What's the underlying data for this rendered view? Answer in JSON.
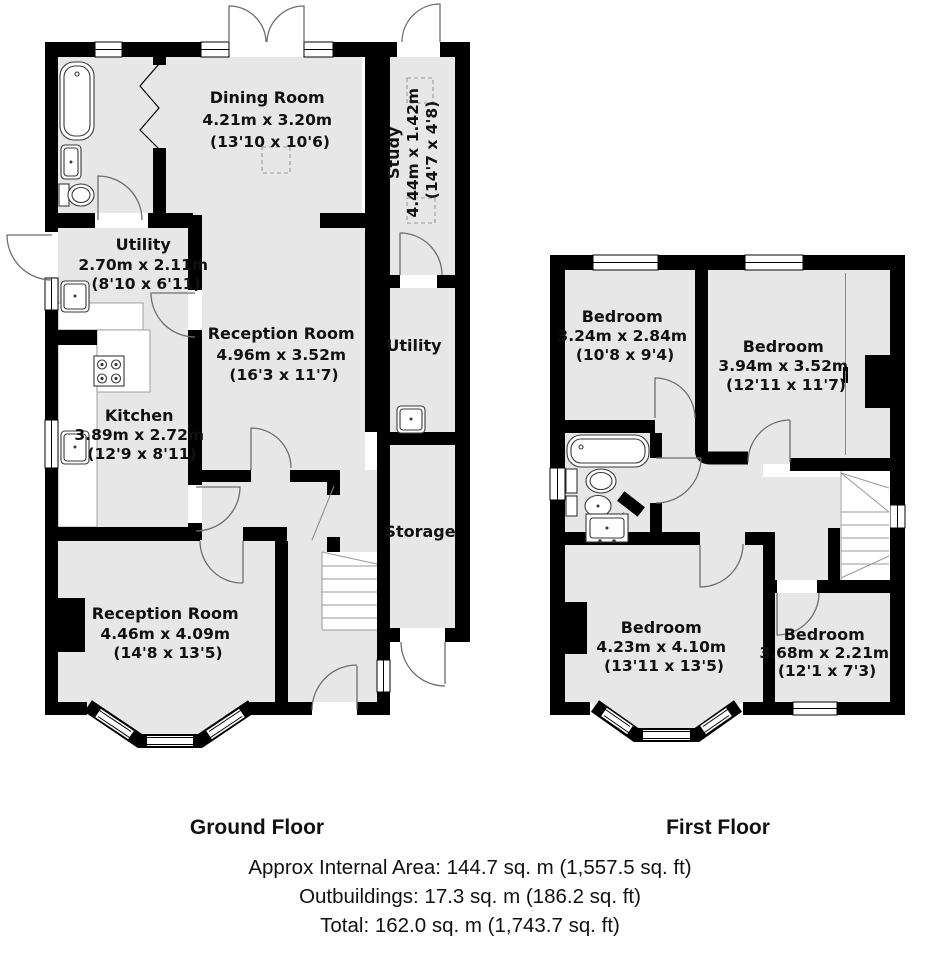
{
  "colors": {
    "wall": "#000000",
    "floor_fill": "#e7e7e7",
    "background": "#ffffff",
    "door_arc": "#6e6e6e"
  },
  "ground_floor": {
    "caption": "Ground Floor",
    "rooms": {
      "dining": {
        "name": "Dining Room",
        "metric": "4.21m x 3.20m",
        "imperial": "(13'10 x 10'6)"
      },
      "study": {
        "name": "Study",
        "metric": "4.44m x 1.42m",
        "imperial": "(14'7 x 4'8)"
      },
      "utility": {
        "name": "Utility",
        "metric": "2.70m x 2.11m",
        "imperial": "(8'10 x 6'11)"
      },
      "reception_top": {
        "name": "Reception Room",
        "metric": "4.96m x 3.52m",
        "imperial": "(16'3 x 11'7)"
      },
      "kitchen": {
        "name": "Kitchen",
        "metric": "3.89m x 2.72m",
        "imperial": "(12'9 x 8'11)"
      },
      "utility2": {
        "name": "Utility"
      },
      "storage": {
        "name": "Storage"
      },
      "reception_bottom": {
        "name": "Reception Room",
        "metric": "4.46m x 4.09m",
        "imperial": "(14'8 x 13'5)"
      }
    }
  },
  "first_floor": {
    "caption": "First Floor",
    "rooms": {
      "bedroom_tl": {
        "name": "Bedroom",
        "metric": "3.24m x 2.84m",
        "imperial": "(10'8 x 9'4)"
      },
      "bedroom_tr": {
        "name": "Bedroom",
        "metric": "3.94m x 3.52m",
        "imperial": "(12'11 x 11'7)"
      },
      "bedroom_bl": {
        "name": "Bedroom",
        "metric": "4.23m x 4.10m",
        "imperial": "(13'11 x 13'5)"
      },
      "bedroom_br": {
        "name": "Bedroom",
        "metric": "3.68m x 2.21m",
        "imperial": "(12'1 x 7'3)"
      }
    }
  },
  "summary": {
    "internal_area": "Approx Internal Area: 144.7 sq. m (1,557.5 sq. ft)",
    "outbuildings": "Outbuildings: 17.3 sq. m (186.2 sq. ft)",
    "total": "Total: 162.0 sq. m (1,743.7 sq. ft)"
  }
}
